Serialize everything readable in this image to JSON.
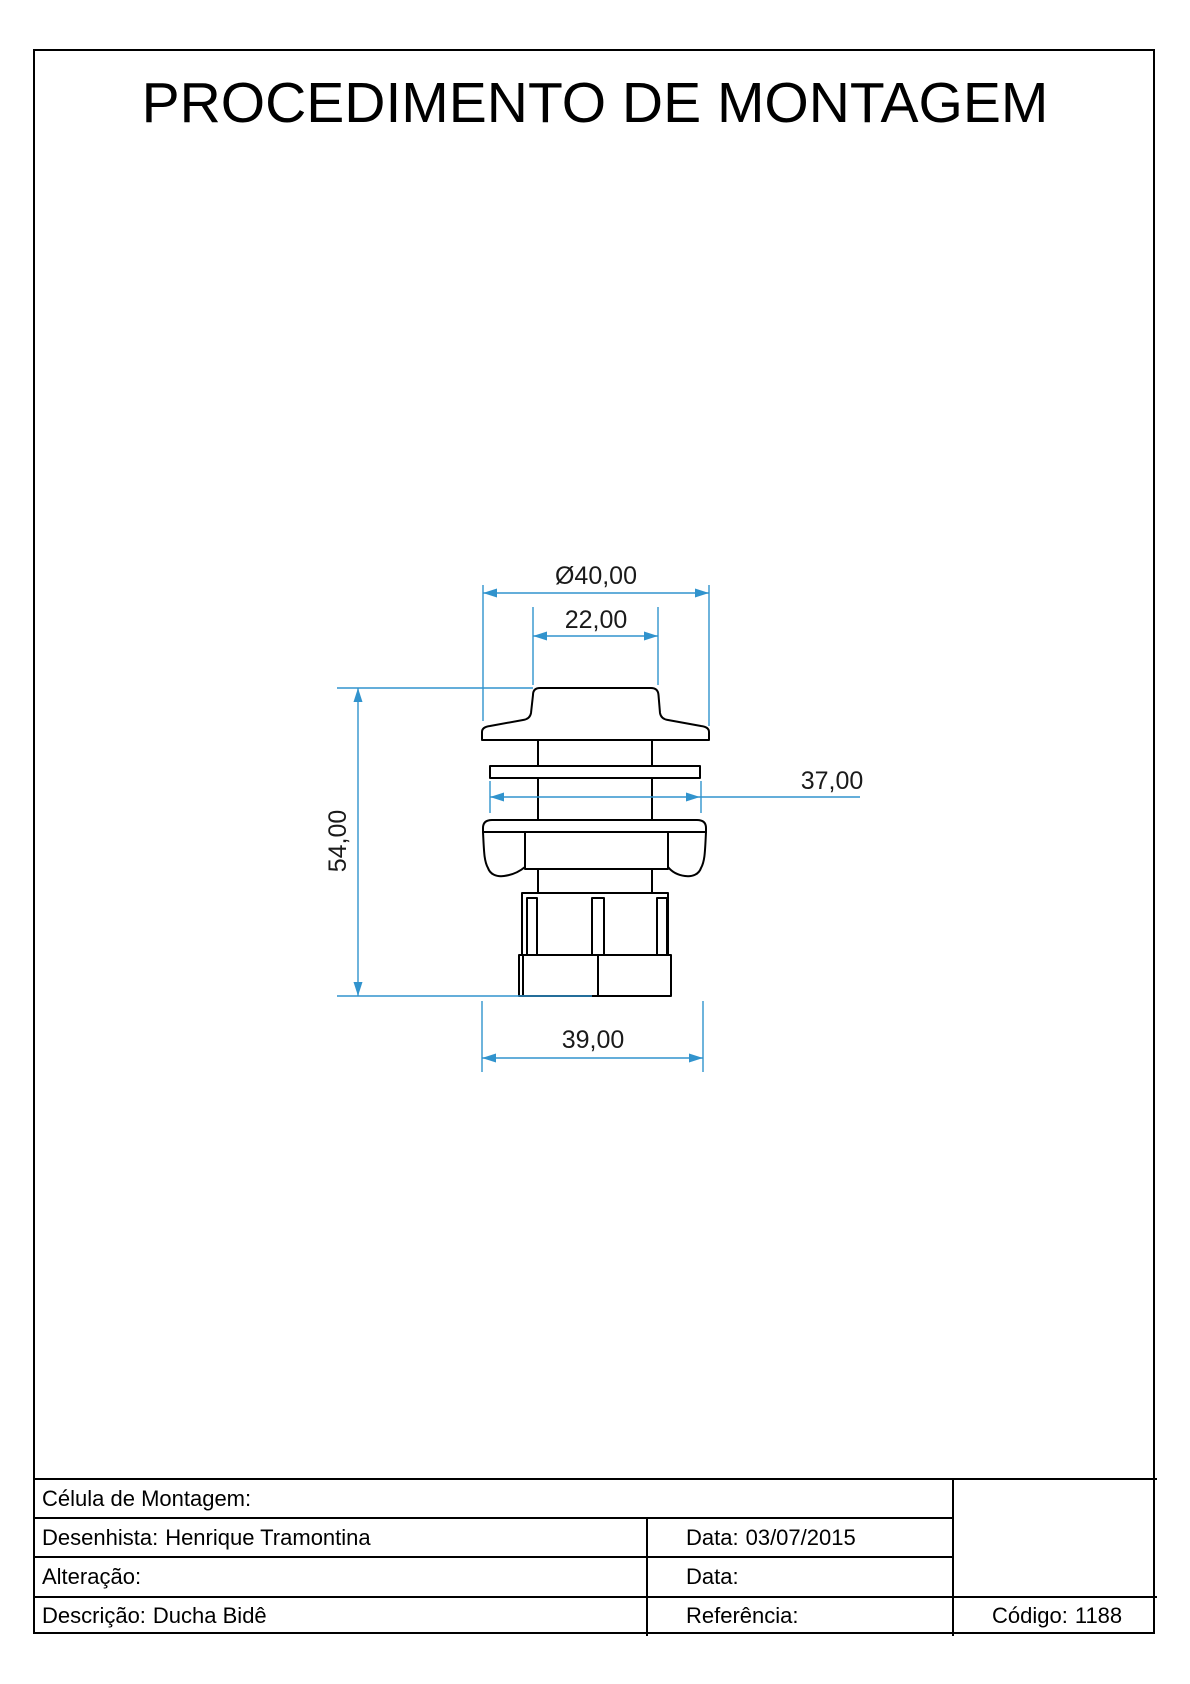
{
  "page": {
    "title": "PROCEDIMENTO DE MONTAGEM"
  },
  "drawing": {
    "type": "technical-drawing",
    "part_view": "front-section of bidet shower fitting",
    "dimensions": {
      "diameter_top": "Ø40,00",
      "cap_width": "22,00",
      "washer_width": "37,00",
      "total_height": "54,00",
      "base_width": "39,00"
    },
    "colors": {
      "dimension_lines": "#3193cd",
      "outline": "#000000"
    }
  },
  "title_block": {
    "celula_label": "Célula de Montagem:",
    "desenhista_label": "Desenhista:",
    "desenhista_value": "Henrique Tramontina",
    "data1_label": "Data:",
    "data1_value": "03/07/2015",
    "alteracao_label": "Alteração:",
    "data2_label": "Data:",
    "descricao_label": "Descrição:",
    "descricao_value": "Ducha Bidê",
    "referencia_label": "Referência:",
    "codigo_label": "Código:",
    "codigo_value": "1188"
  }
}
